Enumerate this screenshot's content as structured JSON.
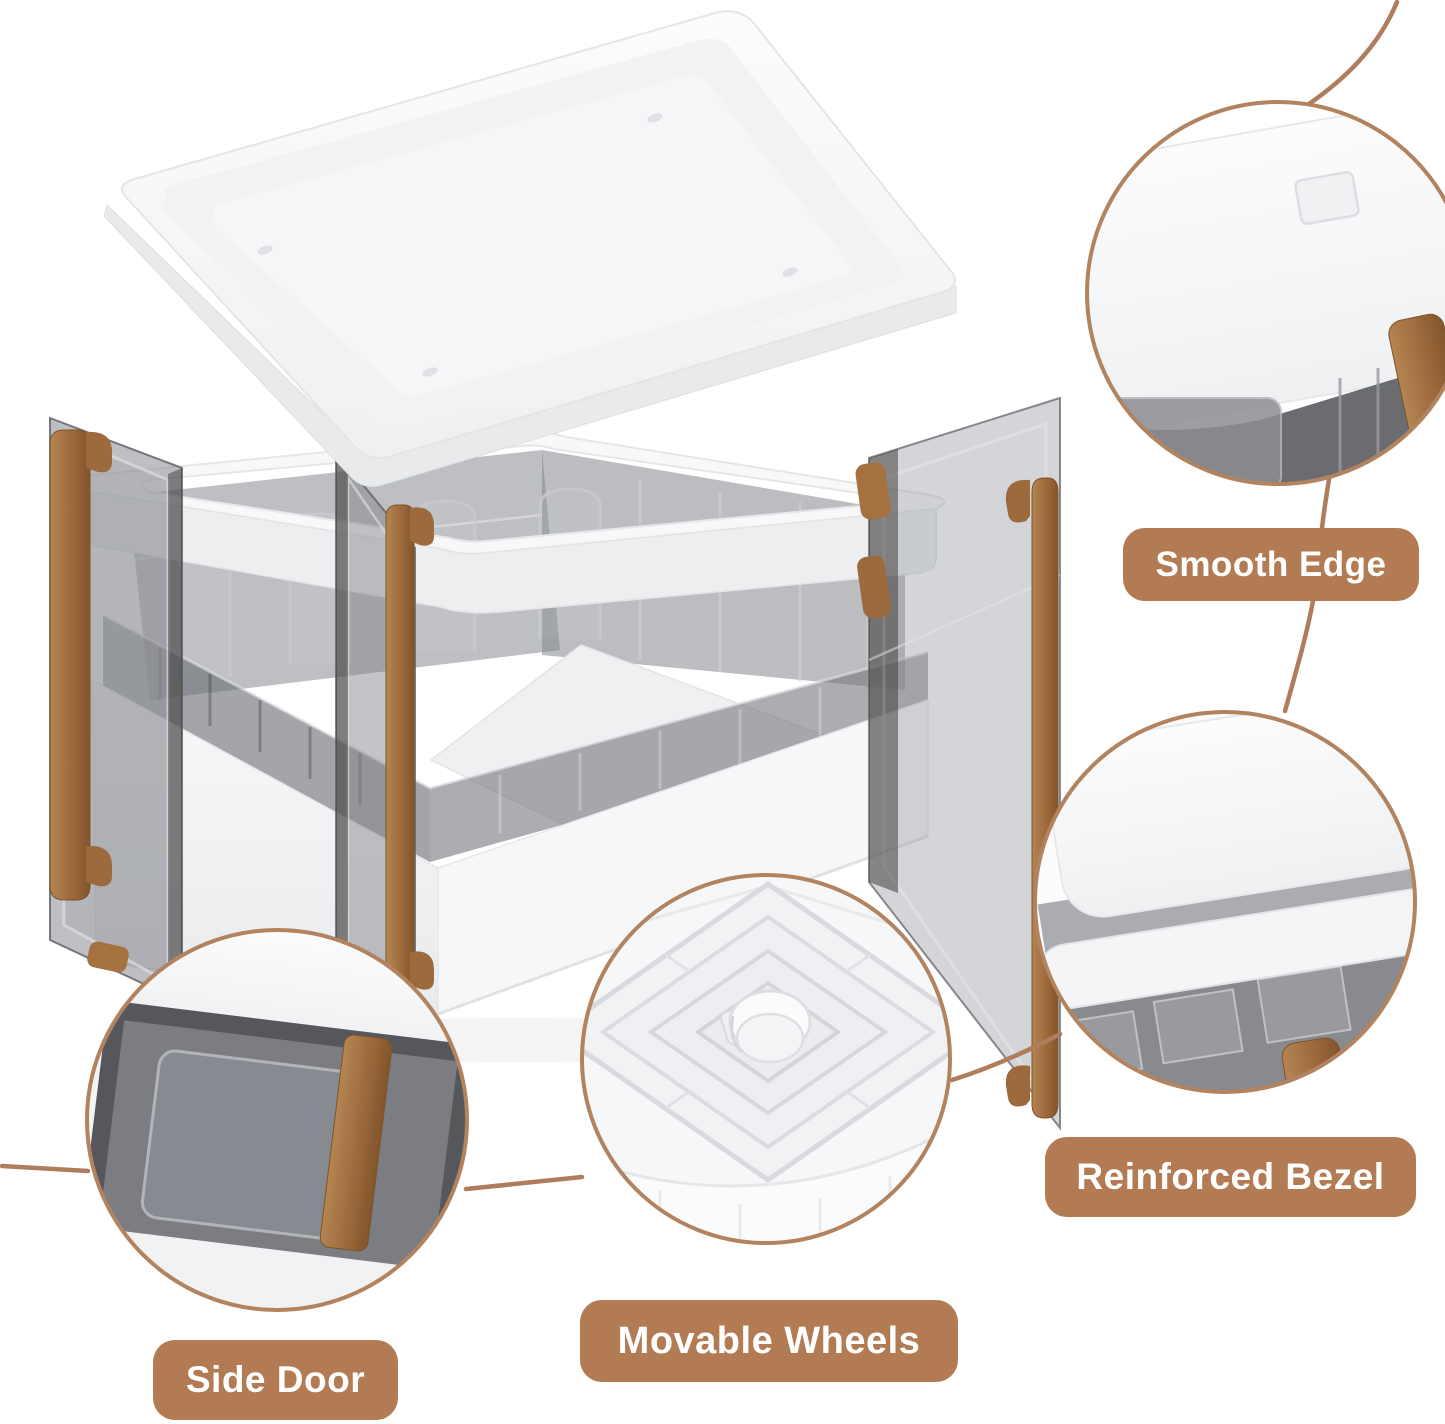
{
  "figure": {
    "type": "product-feature-callouts",
    "background": "#ffffff",
    "colors": {
      "label_bg": "#b37b53",
      "label_text": "#ffffff",
      "leader_line": "#ae7d5b",
      "circle_border": "#b2835f",
      "handle_brown": "#a0713f",
      "white_plastic": "#f6f7f8",
      "smoke_panel": "#77797f"
    },
    "callouts": [
      {
        "id": "smooth-edge",
        "label": "Smooth Edge",
        "position": "top-right"
      },
      {
        "id": "reinforced-bezel",
        "label": "Reinforced Bezel",
        "position": "right"
      },
      {
        "id": "movable-wheels",
        "label": "Movable Wheels",
        "position": "bottom-center"
      },
      {
        "id": "side-door",
        "label": "Side Door",
        "position": "bottom-left"
      }
    ]
  }
}
